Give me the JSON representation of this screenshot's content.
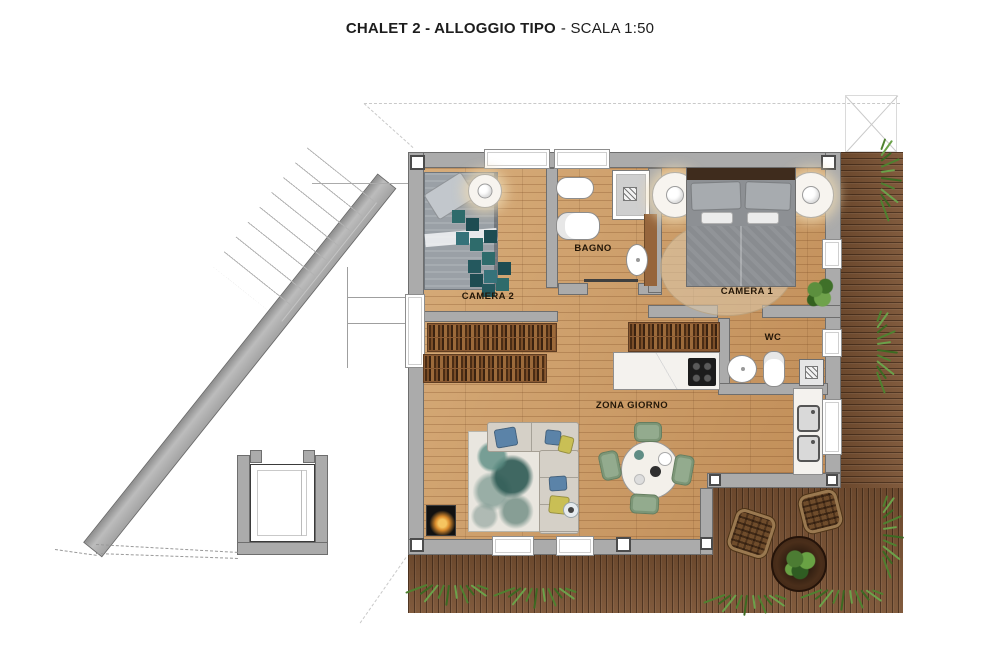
{
  "title": {
    "main": "CHALET 2 - ALLOGGIO TIPO",
    "scale": "- SCALA 1:50"
  },
  "rooms": {
    "camera2": {
      "label": "CAMERA 2"
    },
    "bagno": {
      "label": "BAGNO"
    },
    "camera1": {
      "label": "CAMERA 1"
    },
    "wc": {
      "label": "WC"
    },
    "zona_giorno": {
      "label": "ZONA GIORNO"
    }
  },
  "colors": {
    "floor_wood": "#c9965e",
    "deck_wood": "#7a5233",
    "wall_gray": "#ababab",
    "rug_teal": "#2e6b6b",
    "chair_green": "#93ab8e",
    "pillow_blue": "#5b83a8",
    "pillow_yellow": "#c9bf55",
    "grass_green": "#4f8130"
  }
}
